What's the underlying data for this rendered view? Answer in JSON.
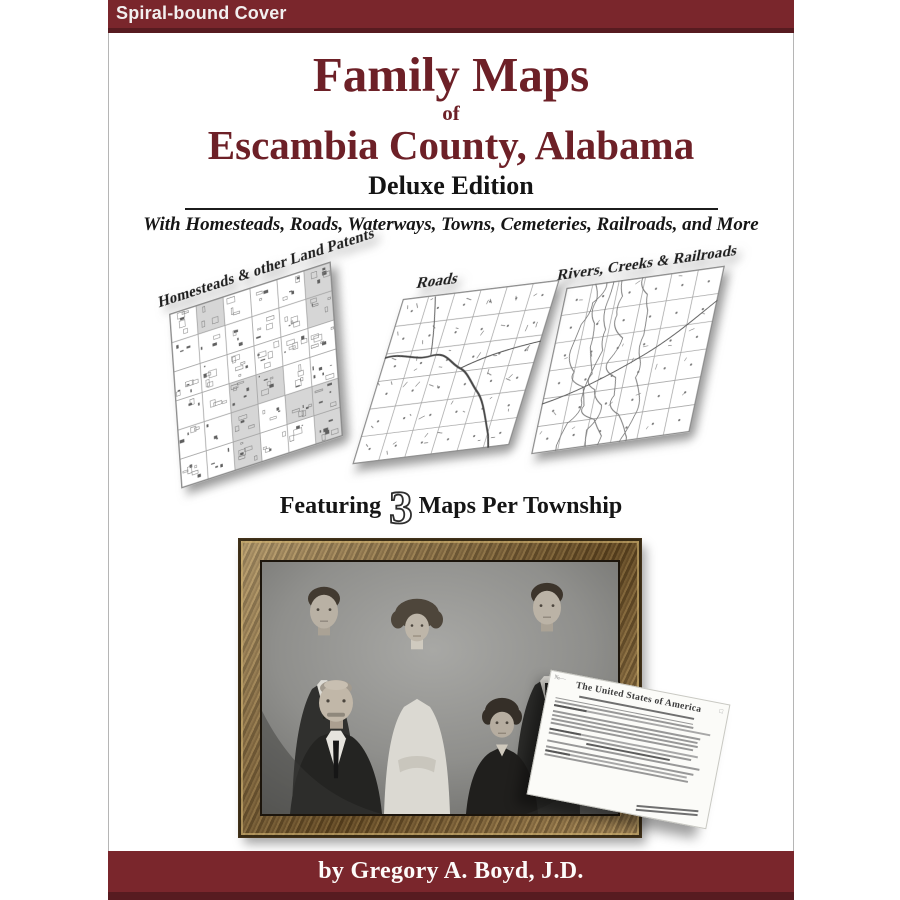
{
  "banner": {
    "label": "Spiral-bound Cover"
  },
  "title": {
    "main": "Family Maps",
    "connector": "of",
    "region": "Escambia County, Alabama",
    "edition": "Deluxe Edition",
    "subtitle": "With Homesteads, Roads, Waterways, Towns, Cemeteries, Railroads, and More"
  },
  "maps": [
    {
      "label": "Homesteads & other Land Patents"
    },
    {
      "label": "Roads"
    },
    {
      "label": "Rivers, Creeks & Railroads"
    }
  ],
  "featuring": {
    "prefix": "Featuring",
    "count": "3",
    "suffix": "Maps Per Township"
  },
  "certificate": {
    "heading": "The United States of America"
  },
  "footer": {
    "byline": "by Gregory A. Boyd, J.D."
  },
  "colors": {
    "maroon": "#7a262c",
    "maroon_dark": "#571b20",
    "title_maroon": "#6d2027"
  }
}
